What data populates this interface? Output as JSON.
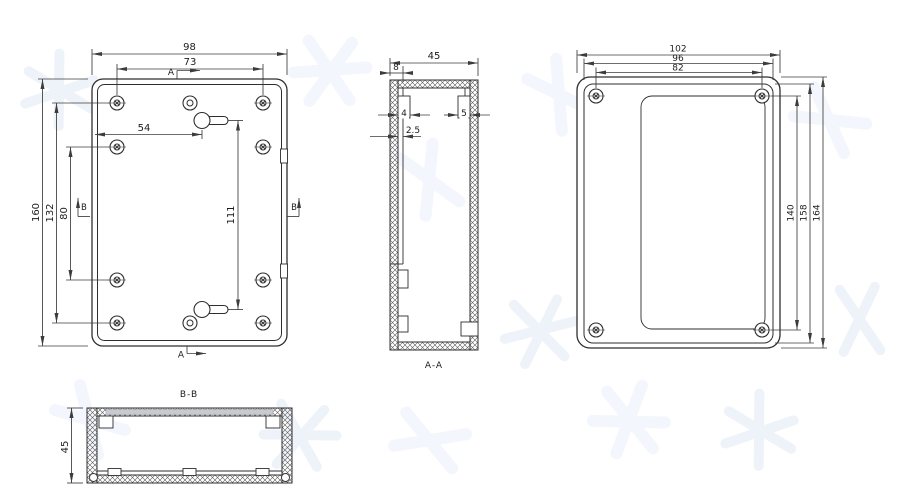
{
  "views": {
    "front": {
      "dims": {
        "outer_width": "98",
        "hole_span_width": "73",
        "keyhole_offset": "54",
        "outer_height": "160",
        "hole_span_height": "132",
        "mid_hole_span": "80",
        "keyhole_span": "111"
      },
      "section_marker_a": "A",
      "section_marker_b": "B"
    },
    "section_aa": {
      "caption": "A-A",
      "dims": {
        "width": "45",
        "wall": "8",
        "left_step": "4",
        "right_step": "5",
        "rib": "2.5"
      }
    },
    "back": {
      "dims": {
        "outer_width": "102",
        "rim_width": "96",
        "hole_span_width": "82",
        "hole_span_height": "140",
        "rim_height": "158",
        "outer_height": "164"
      }
    },
    "section_bb": {
      "caption": "B-B",
      "dims": {
        "height": "45"
      }
    }
  }
}
